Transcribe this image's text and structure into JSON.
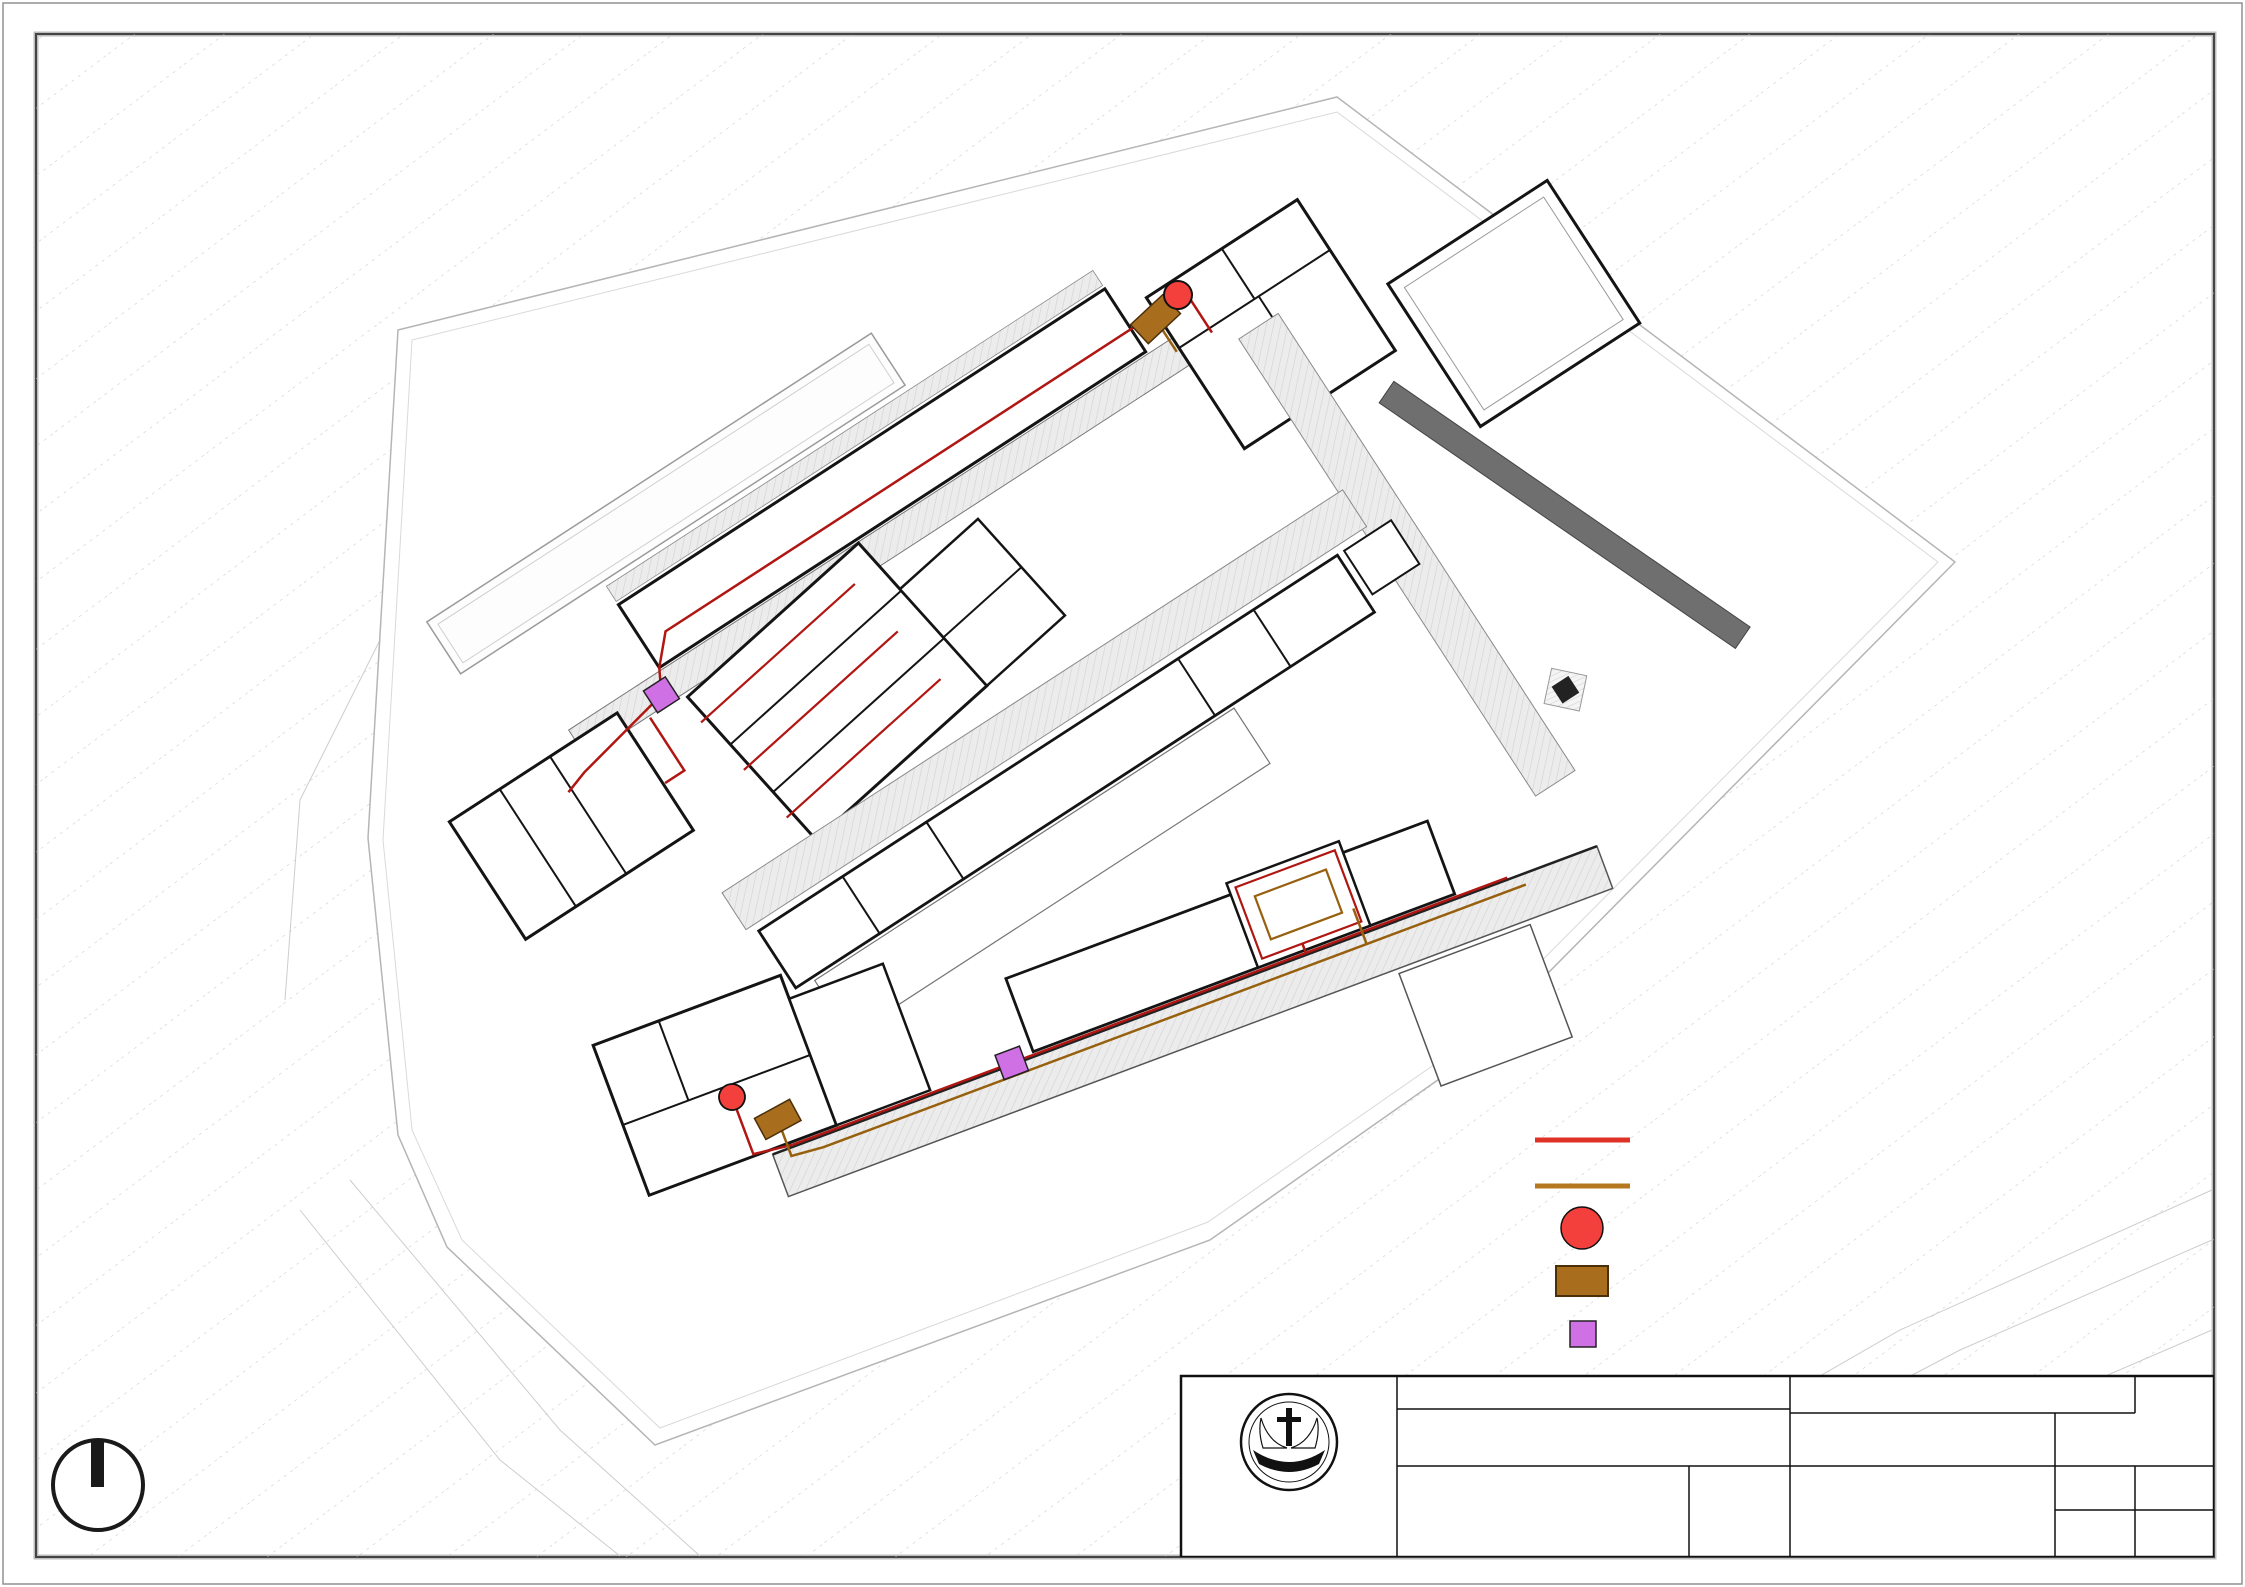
{
  "legend": {
    "items": [
      {
        "label": "SALURAN AIR KOTOR",
        "symbol": "line",
        "color": "#e03127"
      },
      {
        "label": "SALURAN KOTORAN",
        "symbol": "line",
        "color": "#b5781f"
      },
      {
        "label": "SUMUR RESAPAN",
        "symbol": "circle",
        "color": "#f4403c"
      },
      {
        "label": "SEPTIC TANK",
        "symbol": "rect",
        "color": "#a86e1e"
      },
      {
        "label": "BAK KONTROL AIR KOTOR",
        "symbol": "square",
        "color": "#cf70e4"
      }
    ]
  },
  "title_block": {
    "header": "TUGAS AKHIR - SEMESTER GENAP 2023/2024",
    "judul_tugas_label": "JUDUL TUGAS",
    "judul_tugas_line1": "FASILITAS WISATA EDUKASI KOPI",
    "judul_tugas_line2": "KINTAMANI DAN KOPI LUWAK DI BALI",
    "judul_gambar_label": "JUDUL GAMBAR",
    "judul_gambar_line1": "SISTEM UTILITAS AIR",
    "judul_gambar_line2": "KOTOR DAN KOTORAN",
    "skala_label": "SKALA",
    "skala": "1:500",
    "nama_label": "NAMA",
    "nama": "KRISTOFORUS EDUARDO K",
    "nrp_label": "NRP",
    "nrp": "B12200007",
    "kelompok_label": "KELOMPOK",
    "kelompok": "4",
    "mentor_utama_label": "MENTOR UTAMA",
    "mentor_utama": "IR. HANDINOTO,  M. T.",
    "mentor_pendamping_label": "MENTOR PENDAMPING",
    "mentor_pendamping_1": "ANGELA CHRISTYSONIA TAMPUBOLON, S. T., M. T.",
    "mentor_pendamping_2": "Dr. FENY ELSIANA, S. T., M. T.",
    "lembar_label": "LEMBAR",
    "jumlah_label": "JUMLAH",
    "tanggal_label": "TANGGAL",
    "pengesahan_label": "PENGESAHAN",
    "institution_line1": "PROGRAM STUDI ARSITEKTUR",
    "institution_line2": "FAKULTAS TEKNIK SIPIL DAN PERENCANAAN",
    "institution_line3": "UNIVERSITAS KRISTEN PETRA",
    "institution_line4": "SURABAYA",
    "logo_top": "UNIVERSITAS KRISTEN",
    "logo_bottom": "PETRA"
  },
  "plan": {
    "labels": {
      "penangkaran": "PENANGKARAN LUWAK - 11.00",
      "museum_hall": "MUSEUM + GALERI - 3.00",
      "museum_walk": "MUSEUM + GALERI - 3.00",
      "lobi": "LOBI + 0.00",
      "toilet": "TOILET - 1.00",
      "gudang": "GUDANG - 0.00",
      "cafe": "CAFE - 2.00",
      "toko": "TOKO SOUVENIR - 2.00",
      "kelas_a": "KELAS - 1.00",
      "kelas_b": "KELAS - 1.00",
      "road_level": "- 0.34",
      "band1_rooms": [
        "R.COOP - 5.00",
        "R.GRINDING - 5.00",
        "R.ROASTING - 5.00",
        "R.STORAGE ROASTING - 5.00",
        "R.SORTASI - 5.00"
      ],
      "band3_rooms": [
        "R.COOP - 1.00",
        "R.GRINDING - 1.00",
        "R.ROASTING - 1.00",
        "R.SORTASI AKHIR+ GRADING - 1.00",
        "R.HULLING+ CLEANING - 1.00",
        "R.JEMUR - 1.00",
        "R.CUCI - 1.00"
      ],
      "workshop_rooms": [
        "WORKSHOP SEDUH KOPI - 5.00",
        "WORKSHOP BARISTA - 5.00",
        "WORKSHOP ROASTING GRINDING - 5.00"
      ],
      "kelas_ws": [
        "KELAS - 5.00",
        "KELAS - 5.00"
      ],
      "office_rooms": [
        "R.LOKER - 6.00",
        "R.PANTRY - 5.00",
        "AREA KOMUNAL - 5.00",
        "R.RAPAT - 5.00"
      ],
      "luwak_rooms": [
        "R.KARANTINA - 7.00",
        "STORAGE - 9.00",
        "KANDANG LUWAK - 7.00"
      ],
      "service_rooms": [
        "R.PLN - 5.00",
        "R.TPS - 5.00",
        "R.TANDON POMPA - 5.00",
        "DAPUR - 5.00"
      ],
      "parking": [
        "PARKIR - 0.00",
        "PARKIR MOBIL - 1.00",
        "PARKIR MOBIL - 1.00",
        "PARKIR MOBIL - 1.00"
      ]
    },
    "colors": {
      "air_kotor": "#b01612",
      "kotoran": "#96600f",
      "sumur_resapan": "#f4403c",
      "septic": "#a86e1e",
      "bak_kontrol": "#cf70e4"
    }
  }
}
